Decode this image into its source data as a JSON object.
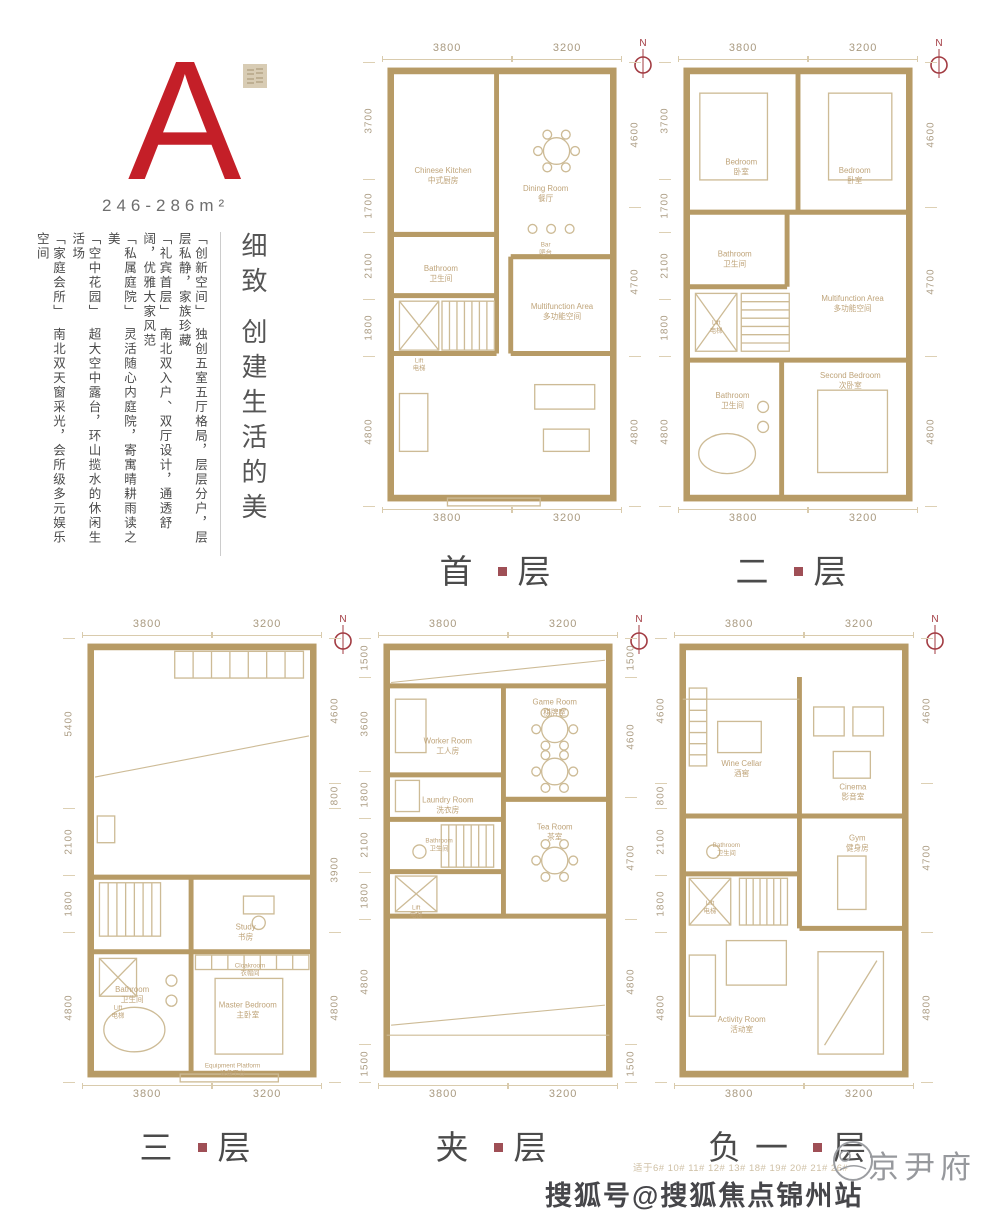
{
  "colors": {
    "accent": "#c41f28",
    "wall": "#b79b66",
    "thin_line": "#cdbb96",
    "room_text": "#bfa47a",
    "dim_text": "#ac9d84",
    "dot": "#8e3038",
    "compass": "#a23b42",
    "title_text": "#4b4b4b"
  },
  "compass_label": "N",
  "unit": {
    "letter": "A",
    "area": "246-286m²"
  },
  "intro": {
    "title": "细致 创建生活的美",
    "paragraphs": [
      "「创新空间」　独创五室五厅格局，层层分户，层层私静，家族珍藏",
      "「礼宾首层」　南北双入户、双厅设计，通透舒阔，优雅大家风范",
      "「私属庭院」　灵活随心内庭院，寄寓晴耕雨读之美",
      "「空中花园」　超大空中露台，环山揽水的休闲生活场",
      "「家庭会所」　南北双天窗采光，会所级多元娱乐空间"
    ]
  },
  "footer": {
    "applicability": "适于6# 10# 11# 12# 13# 18# 19# 20# 21# 26#",
    "brand": "京尹府",
    "watermark": "搜狐号@搜狐焦点锦州站"
  },
  "plans": [
    {
      "id": "first-floor",
      "title_parts": [
        "首",
        "层"
      ],
      "top_dims": [
        "3800",
        "3200"
      ],
      "bottom_dims": [
        "3800",
        "3200"
      ],
      "left_dims": [
        "3700",
        "1700",
        "2100",
        "1800",
        "4800"
      ],
      "right_dims": [
        "4600",
        "4700",
        "4800"
      ],
      "walls": [
        [
          105,
          8,
          105,
          155
        ],
        [
          8,
          155,
          105,
          155
        ],
        [
          8,
          210,
          105,
          210
        ],
        [
          105,
          155,
          105,
          262
        ],
        [
          8,
          262,
          105,
          262
        ],
        [
          118,
          175,
          212,
          175
        ],
        [
          118,
          175,
          118,
          262
        ],
        [
          118,
          262,
          212,
          262
        ]
      ],
      "lines": [],
      "features": [
        {
          "t": "dtable",
          "x": 160,
          "y": 80
        },
        {
          "t": "circle",
          "x": 138,
          "y": 150,
          "r": 4
        },
        {
          "t": "circle",
          "x": 155,
          "y": 150,
          "r": 4
        },
        {
          "t": "circle",
          "x": 172,
          "y": 150,
          "r": 4
        },
        {
          "t": "stair",
          "x": 55,
          "y": 215,
          "w": 48,
          "h": 44
        },
        {
          "t": "xbox",
          "x": 16,
          "y": 215,
          "w": 36,
          "h": 44
        },
        {
          "t": "rect",
          "x": 140,
          "y": 290,
          "w": 55,
          "h": 22
        },
        {
          "t": "rect",
          "x": 16,
          "y": 298,
          "w": 26,
          "h": 52
        },
        {
          "t": "rect",
          "x": 148,
          "y": 330,
          "w": 42,
          "h": 20
        },
        {
          "t": "rect",
          "x": 60,
          "y": 392,
          "w": 85,
          "h": 7
        }
      ],
      "rooms": [
        {
          "en": "Chinese Kitchen",
          "zh": "中式厨房",
          "x": 56,
          "y": 100
        },
        {
          "en": "Dining Room",
          "zh": "餐厅",
          "x": 150,
          "y": 116
        },
        {
          "en": "Bar",
          "zh": "吧台",
          "x": 150,
          "y": 166,
          "s": 1
        },
        {
          "en": "Bathroom",
          "zh": "卫生间",
          "x": 54,
          "y": 188
        },
        {
          "en": "Lift",
          "zh": "电梯",
          "x": 34,
          "y": 270,
          "s": 1
        },
        {
          "en": "Multifunction Area",
          "zh": "多功能空间",
          "x": 165,
          "y": 222
        }
      ]
    },
    {
      "id": "second-floor",
      "title_parts": [
        "二",
        "层"
      ],
      "top_dims": [
        "3800",
        "3200"
      ],
      "bottom_dims": [
        "3800",
        "3200"
      ],
      "left_dims": [
        "3700",
        "1700",
        "2100",
        "1800",
        "4800"
      ],
      "right_dims": [
        "4600",
        "4700",
        "4800"
      ],
      "walls": [
        [
          110,
          8,
          110,
          135
        ],
        [
          8,
          135,
          212,
          135
        ],
        [
          8,
          202,
          100,
          202
        ],
        [
          100,
          135,
          100,
          202
        ],
        [
          8,
          268,
          212,
          268
        ],
        [
          95,
          268,
          95,
          392
        ]
      ],
      "lines": [],
      "features": [
        {
          "t": "rect",
          "x": 20,
          "y": 28,
          "w": 62,
          "h": 78
        },
        {
          "t": "rect",
          "x": 138,
          "y": 28,
          "w": 58,
          "h": 78
        },
        {
          "t": "stair",
          "x": 58,
          "y": 208,
          "w": 44,
          "h": 52
        },
        {
          "t": "xbox",
          "x": 16,
          "y": 208,
          "w": 38,
          "h": 52
        },
        {
          "t": "ellipse",
          "x": 45,
          "y": 352,
          "rx": 26,
          "ry": 18
        },
        {
          "t": "circle",
          "x": 78,
          "y": 310,
          "r": 5
        },
        {
          "t": "circle",
          "x": 78,
          "y": 328,
          "r": 5
        },
        {
          "t": "rect",
          "x": 128,
          "y": 295,
          "w": 64,
          "h": 74
        }
      ],
      "rooms": [
        {
          "en": "Bedroom",
          "zh": "卧室",
          "x": 58,
          "y": 92
        },
        {
          "en": "Bedroom",
          "zh": "卧室",
          "x": 162,
          "y": 100
        },
        {
          "en": "Bathroom",
          "zh": "卫生间",
          "x": 52,
          "y": 175
        },
        {
          "en": "Multifunction Area",
          "zh": "多功能空间",
          "x": 160,
          "y": 215
        },
        {
          "en": "Lift",
          "zh": "电梯",
          "x": 35,
          "y": 236,
          "s": 1
        },
        {
          "en": "Bathroom",
          "zh": "卫生间",
          "x": 50,
          "y": 302
        },
        {
          "en": "Second Bedroom",
          "zh": "次卧室",
          "x": 158,
          "y": 284
        }
      ]
    },
    {
      "id": "third-floor",
      "title_parts": [
        "三",
        "层"
      ],
      "top_dims": [
        "3800",
        "3200"
      ],
      "bottom_dims": [
        "3800",
        "3200"
      ],
      "left_dims": [
        "5400",
        "2100",
        "1800",
        "4800"
      ],
      "right_dims": [
        "4600",
        "800",
        "3900",
        "4800"
      ],
      "walls": [
        [
          8,
          215,
          212,
          215
        ],
        [
          100,
          215,
          100,
          392
        ],
        [
          8,
          282,
          100,
          282
        ],
        [
          100,
          282,
          212,
          282
        ]
      ],
      "lines": [
        {
          "t": "line",
          "x1": 12,
          "y1": 125,
          "x2": 208,
          "y2": 88
        }
      ],
      "features": [
        {
          "t": "stair",
          "x": 85,
          "y": 12,
          "w": 118,
          "h": 24
        },
        {
          "t": "rect",
          "x": 14,
          "y": 160,
          "w": 16,
          "h": 24
        },
        {
          "t": "stair",
          "x": 16,
          "y": 220,
          "w": 56,
          "h": 48
        },
        {
          "t": "xbox",
          "x": 16,
          "y": 288,
          "w": 34,
          "h": 34
        },
        {
          "t": "rect",
          "x": 148,
          "y": 232,
          "w": 28,
          "h": 16
        },
        {
          "t": "circle",
          "x": 162,
          "y": 256,
          "r": 6
        },
        {
          "t": "stair",
          "x": 104,
          "y": 285,
          "w": 104,
          "h": 13
        },
        {
          "t": "rect",
          "x": 122,
          "y": 306,
          "w": 62,
          "h": 68
        },
        {
          "t": "ellipse",
          "x": 48,
          "y": 352,
          "rx": 28,
          "ry": 20
        },
        {
          "t": "circle",
          "x": 82,
          "y": 308,
          "r": 5
        },
        {
          "t": "circle",
          "x": 82,
          "y": 326,
          "r": 5
        },
        {
          "t": "rect",
          "x": 90,
          "y": 392,
          "w": 90,
          "h": 7
        }
      ],
      "rooms": [
        {
          "en": "Study",
          "zh": "书房",
          "x": 150,
          "y": 262
        },
        {
          "en": "Lift",
          "zh": "电梯",
          "x": 33,
          "y": 334,
          "s": 1
        },
        {
          "en": "Cloakroom",
          "zh": "衣帽间",
          "x": 154,
          "y": 296,
          "s": 1
        },
        {
          "en": "Master Bedroom",
          "zh": "主卧室",
          "x": 152,
          "y": 332
        },
        {
          "en": "Bathroom",
          "zh": "卫生间",
          "x": 46,
          "y": 318
        },
        {
          "en": "Equipment Platform",
          "zh": "设备平台",
          "x": 138,
          "y": 386,
          "s": 1
        }
      ]
    },
    {
      "id": "mezzanine",
      "title_parts": [
        "夹",
        "层"
      ],
      "top_dims": [
        "3800",
        "3200"
      ],
      "bottom_dims": [
        "3800",
        "3200"
      ],
      "left_dims": [
        "1500",
        "3600",
        "1800",
        "2100",
        "1800",
        "4800",
        "1500"
      ],
      "right_dims": [
        "1500",
        "4600",
        "4700",
        "4800",
        "1500"
      ],
      "walls": [
        [
          8,
          43,
          212,
          43
        ],
        [
          115,
          43,
          115,
          250
        ],
        [
          8,
          123,
          115,
          123
        ],
        [
          8,
          163,
          115,
          163
        ],
        [
          8,
          210,
          115,
          210
        ],
        [
          115,
          145,
          212,
          145
        ],
        [
          8,
          250,
          212,
          250
        ]
      ],
      "lines": [
        {
          "t": "line",
          "x1": 8,
          "y1": 357,
          "x2": 212,
          "y2": 357
        },
        {
          "t": "line",
          "x1": 12,
          "y1": 40,
          "x2": 208,
          "y2": 20
        },
        {
          "t": "line",
          "x1": 12,
          "y1": 348,
          "x2": 208,
          "y2": 330
        }
      ],
      "features": [
        {
          "t": "rect",
          "x": 16,
          "y": 55,
          "w": 28,
          "h": 48
        },
        {
          "t": "dtable",
          "x": 162,
          "y": 82
        },
        {
          "t": "dtable",
          "x": 162,
          "y": 120
        },
        {
          "t": "dtable",
          "x": 162,
          "y": 200
        },
        {
          "t": "rect",
          "x": 16,
          "y": 128,
          "w": 22,
          "h": 28
        },
        {
          "t": "stair",
          "x": 58,
          "y": 168,
          "w": 48,
          "h": 38
        },
        {
          "t": "xbox",
          "x": 16,
          "y": 214,
          "w": 38,
          "h": 32
        },
        {
          "t": "circle",
          "x": 38,
          "y": 192,
          "r": 6
        }
      ],
      "rooms": [
        {
          "en": "Worker Room",
          "zh": "工人房",
          "x": 64,
          "y": 95
        },
        {
          "en": "Game Room",
          "zh": "棋牌室",
          "x": 162,
          "y": 60
        },
        {
          "en": "Laundry Room",
          "zh": "洗衣房",
          "x": 64,
          "y": 148
        },
        {
          "en": "Bathroom",
          "zh": "卫生间",
          "x": 56,
          "y": 184,
          "s": 1
        },
        {
          "en": "Tea Room",
          "zh": "茶室",
          "x": 162,
          "y": 172
        },
        {
          "en": "Lift",
          "zh": "电梯",
          "x": 35,
          "y": 244,
          "s": 1
        }
      ]
    },
    {
      "id": "basement",
      "title_parts": [
        "负一",
        "层"
      ],
      "top_dims": [
        "3800",
        "3200"
      ],
      "bottom_dims": [
        "3800",
        "3200"
      ],
      "left_dims": [
        "4600",
        "800",
        "2100",
        "1800",
        "4800"
      ],
      "right_dims": [
        "4600",
        "4700",
        "4800"
      ],
      "walls": [
        [
          115,
          35,
          115,
          160
        ],
        [
          8,
          160,
          212,
          160
        ],
        [
          8,
          212,
          115,
          212
        ],
        [
          115,
          160,
          115,
          261
        ],
        [
          115,
          261,
          212,
          261
        ]
      ],
      "lines": [
        {
          "t": "line",
          "x1": 8,
          "y1": 55,
          "x2": 115,
          "y2": 55
        }
      ],
      "features": [
        {
          "t": "stair",
          "x": 14,
          "y": 45,
          "w": 16,
          "h": 70
        },
        {
          "t": "rect",
          "x": 40,
          "y": 75,
          "w": 40,
          "h": 28
        },
        {
          "t": "rect",
          "x": 128,
          "y": 62,
          "w": 28,
          "h": 26
        },
        {
          "t": "rect",
          "x": 164,
          "y": 62,
          "w": 28,
          "h": 26
        },
        {
          "t": "rect",
          "x": 146,
          "y": 102,
          "w": 34,
          "h": 24
        },
        {
          "t": "circle",
          "x": 36,
          "y": 192,
          "r": 6
        },
        {
          "t": "stair",
          "x": 60,
          "y": 216,
          "w": 44,
          "h": 42
        },
        {
          "t": "xbox",
          "x": 14,
          "y": 216,
          "w": 38,
          "h": 42
        },
        {
          "t": "rect",
          "x": 150,
          "y": 196,
          "w": 26,
          "h": 48
        },
        {
          "t": "rect",
          "x": 132,
          "y": 282,
          "w": 60,
          "h": 92
        },
        {
          "t": "line",
          "x1": 138,
          "y1": 366,
          "x2": 186,
          "y2": 290
        },
        {
          "t": "rect",
          "x": 14,
          "y": 285,
          "w": 24,
          "h": 55
        },
        {
          "t": "rect",
          "x": 48,
          "y": 272,
          "w": 55,
          "h": 40
        }
      ],
      "rooms": [
        {
          "en": "Wine Cellar",
          "zh": "酒窖",
          "x": 62,
          "y": 115
        },
        {
          "en": "Cinema",
          "zh": "影音室",
          "x": 164,
          "y": 136
        },
        {
          "en": "Bathroom",
          "zh": "卫生间",
          "x": 48,
          "y": 188,
          "s": 1
        },
        {
          "en": "Gym",
          "zh": "健身房",
          "x": 168,
          "y": 182
        },
        {
          "en": "Lift",
          "zh": "电梯",
          "x": 33,
          "y": 240,
          "s": 1
        },
        {
          "en": "Activity Room",
          "zh": "活动室",
          "x": 62,
          "y": 345
        }
      ]
    }
  ]
}
